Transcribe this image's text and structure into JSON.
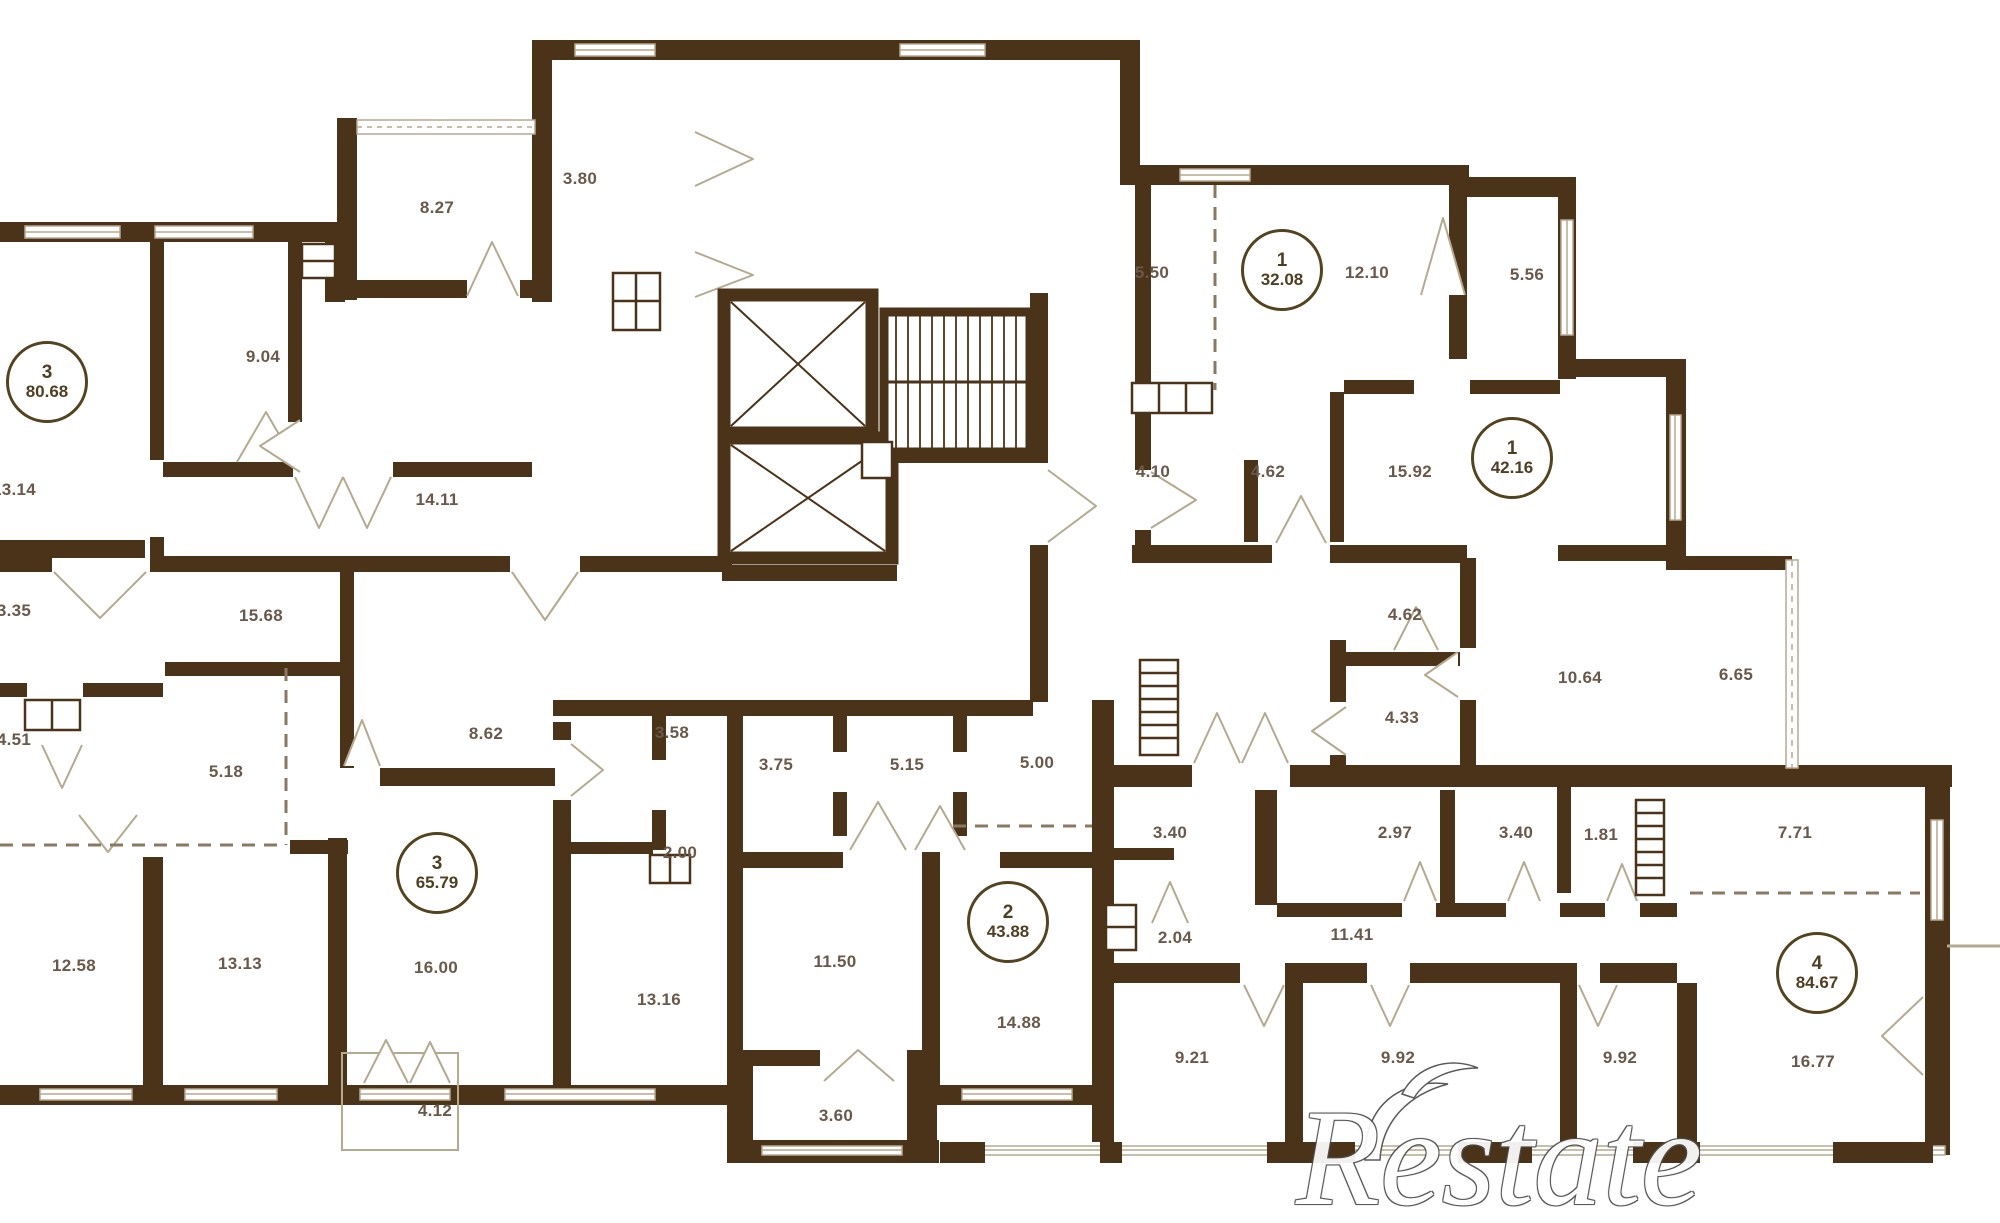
{
  "page": {
    "type": "apartment-floor-plan"
  },
  "colors": {
    "wall": "#4a3318",
    "window_line": "#b5a98f",
    "dash_line": "#8a7960",
    "room_label": "#6a594a",
    "apartment_circle": "#4f3f22",
    "watermark_outline": "#4e4e4e"
  },
  "watermark": {
    "text": "Restate"
  },
  "apartments": [
    {
      "rooms": "3",
      "area": "80.68",
      "x": 47,
      "y": 382
    },
    {
      "rooms": "1",
      "area": "32.08",
      "x": 1282,
      "y": 270
    },
    {
      "rooms": "1",
      "area": "42.16",
      "x": 1512,
      "y": 458
    },
    {
      "rooms": "3",
      "area": "65.79",
      "x": 437,
      "y": 873
    },
    {
      "rooms": "2",
      "area": "43.88",
      "x": 1008,
      "y": 922
    },
    {
      "rooms": "4",
      "area": "84.67",
      "x": 1817,
      "y": 973
    }
  ],
  "room_labels": [
    {
      "label": "8.27",
      "x": 437,
      "y": 208
    },
    {
      "label": "3.80",
      "x": 580,
      "y": 179
    },
    {
      "label": "9.04",
      "x": 263,
      "y": 357
    },
    {
      "label": "13.14",
      "x": 14,
      "y": 490
    },
    {
      "label": "14.11",
      "x": 437,
      "y": 500
    },
    {
      "label": "15.68",
      "x": 261,
      "y": 616
    },
    {
      "label": "3.35",
      "x": 14,
      "y": 611
    },
    {
      "label": "4.51",
      "x": 14,
      "y": 740
    },
    {
      "label": "5.18",
      "x": 226,
      "y": 772
    },
    {
      "label": "12.58",
      "x": 74,
      "y": 966
    },
    {
      "label": "13.13",
      "x": 240,
      "y": 964
    },
    {
      "label": "8.62",
      "x": 486,
      "y": 734
    },
    {
      "label": "3.58",
      "x": 672,
      "y": 733
    },
    {
      "label": "2.00",
      "x": 680,
      "y": 853
    },
    {
      "label": "16.00",
      "x": 436,
      "y": 968
    },
    {
      "label": "13.16",
      "x": 659,
      "y": 1000
    },
    {
      "label": "3.75",
      "x": 776,
      "y": 765
    },
    {
      "label": "5.15",
      "x": 907,
      "y": 765
    },
    {
      "label": "5.00",
      "x": 1037,
      "y": 763
    },
    {
      "label": "11.50",
      "x": 835,
      "y": 962
    },
    {
      "label": "14.88",
      "x": 1019,
      "y": 1023
    },
    {
      "label": "4.12",
      "x": 435,
      "y": 1111
    },
    {
      "label": "3.60",
      "x": 836,
      "y": 1116
    },
    {
      "label": "5.50",
      "x": 1152,
      "y": 273
    },
    {
      "label": "12.10",
      "x": 1367,
      "y": 273
    },
    {
      "label": "5.56",
      "x": 1527,
      "y": 275
    },
    {
      "label": "4.10",
      "x": 1153,
      "y": 472
    },
    {
      "label": "4.62",
      "x": 1268,
      "y": 472
    },
    {
      "label": "15.92",
      "x": 1410,
      "y": 472
    },
    {
      "label": "4.62",
      "x": 1405,
      "y": 615
    },
    {
      "label": "4.33",
      "x": 1402,
      "y": 718
    },
    {
      "label": "10.64",
      "x": 1580,
      "y": 678
    },
    {
      "label": "6.65",
      "x": 1736,
      "y": 675
    },
    {
      "label": "3.40",
      "x": 1170,
      "y": 833
    },
    {
      "label": "2.97",
      "x": 1395,
      "y": 833
    },
    {
      "label": "3.40",
      "x": 1516,
      "y": 833
    },
    {
      "label": "1.81",
      "x": 1601,
      "y": 835
    },
    {
      "label": "7.71",
      "x": 1795,
      "y": 833
    },
    {
      "label": "2.04",
      "x": 1175,
      "y": 938
    },
    {
      "label": "11.41",
      "x": 1352,
      "y": 935
    },
    {
      "label": "9.21",
      "x": 1192,
      "y": 1058
    },
    {
      "label": "9.92",
      "x": 1398,
      "y": 1058
    },
    {
      "label": "9.92",
      "x": 1620,
      "y": 1058
    },
    {
      "label": "16.77",
      "x": 1813,
      "y": 1062
    }
  ]
}
